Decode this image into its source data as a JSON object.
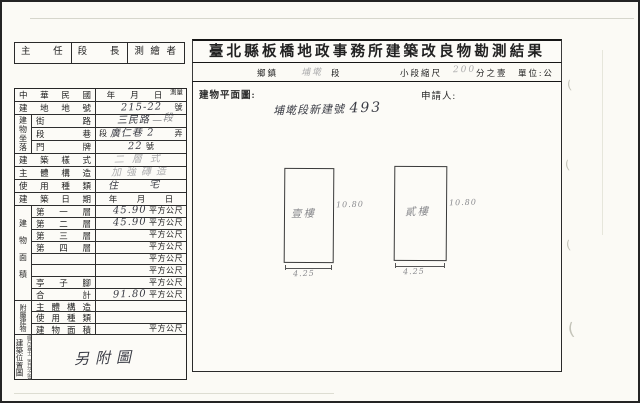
{
  "colors": {
    "ink": "#222222",
    "hand_ink": "#3b3d46",
    "border": "#242424",
    "faint": "#c3c3b8"
  },
  "signature": {
    "cells": [
      "主任",
      "段長",
      "測繪者"
    ]
  },
  "header": {
    "title": "臺北縣板橋地政事務所建築改良物勘測結果",
    "scale": {
      "township_label": "鄉鎮",
      "section_hand": "埔墘",
      "section_label": "段",
      "small_section_label": "小段縮尺",
      "scale_hand": "200",
      "scale_suffix": "分之壹",
      "unit_label": "單位:公尺"
    }
  },
  "form": {
    "minguo": {
      "label": "中華民國",
      "year": "年",
      "month": "月",
      "day": "日",
      "small": "測量"
    },
    "lot": {
      "label": "建地地號",
      "hand": "215-22",
      "suffix": "號"
    },
    "location": {
      "group": "建物坐落",
      "street": {
        "label": "街路",
        "hand": "三民路",
        "hand_small": "二段"
      },
      "lane": {
        "label": "段巷",
        "pre": "段",
        "hand": "廣仁巷 2",
        "suffix": "弄"
      },
      "door": {
        "label": "門牌",
        "hand": "22",
        "suffix": "號"
      }
    },
    "style": {
      "label": "建築樣式",
      "hand": "二層式"
    },
    "structure": {
      "label": "主體構造",
      "hand": "加強磚造"
    },
    "usage": {
      "label": "使用種類",
      "hand": "住 宅"
    },
    "build_date": {
      "label": "建築日期",
      "year": "年",
      "month": "月",
      "day": "日"
    },
    "area": {
      "group": "建物面積",
      "rows": [
        {
          "label": "第一層",
          "hand": "45.90",
          "unit": "平方公尺"
        },
        {
          "label": "第二層",
          "hand": "45.90",
          "unit": "平方公尺"
        },
        {
          "label": "第三層",
          "hand": "",
          "unit": "平方公尺"
        },
        {
          "label": "第四層",
          "hand": "",
          "unit": "平方公尺"
        },
        {
          "label": "",
          "hand": "",
          "unit": "平方公尺"
        },
        {
          "label": "",
          "hand": "",
          "unit": "平方公尺"
        },
        {
          "label": "亭子腳",
          "hand": "",
          "unit": "平方公尺"
        },
        {
          "label": "合計",
          "hand": "91.80",
          "unit": "平方公尺"
        }
      ]
    },
    "annex": {
      "group": "附屬建物",
      "rows": [
        {
          "label": "主體構造",
          "hand": "",
          "unit": ""
        },
        {
          "label": "使用種類",
          "hand": "",
          "unit": ""
        },
        {
          "label": "建物面積",
          "hand": "",
          "unit": "平方公尺"
        }
      ]
    },
    "sitemap": {
      "group": "建築位置圖",
      "group_note": "縮尺壹千二百分之壹",
      "hand": "另附圖"
    }
  },
  "plan": {
    "label": "建物平面圖:",
    "applicant": "申請人:",
    "hand_title": "埔墘段新建號",
    "hand_title_no": "493",
    "floors": [
      {
        "name": "壹樓",
        "height": "10.80",
        "width": "4.25"
      },
      {
        "name": "貳樓",
        "height": "10.80",
        "width": "4.25"
      }
    ]
  }
}
